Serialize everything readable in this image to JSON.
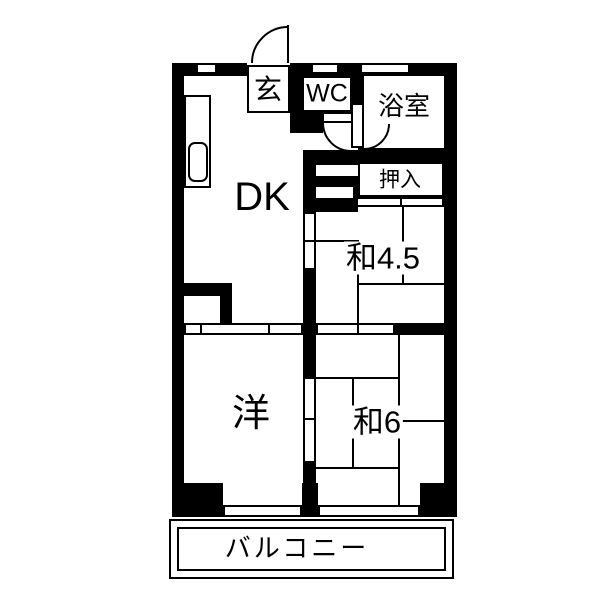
{
  "floorplan": {
    "rooms": {
      "genkan": "玄",
      "wc": "WC",
      "bath": "浴室",
      "closet": "押入",
      "dk": "DK",
      "tatami45": "和4.5",
      "western": "洋",
      "tatami6": "和6",
      "balcony": "バルコニー"
    },
    "colors": {
      "wall": "#000000",
      "background": "#ffffff"
    }
  }
}
